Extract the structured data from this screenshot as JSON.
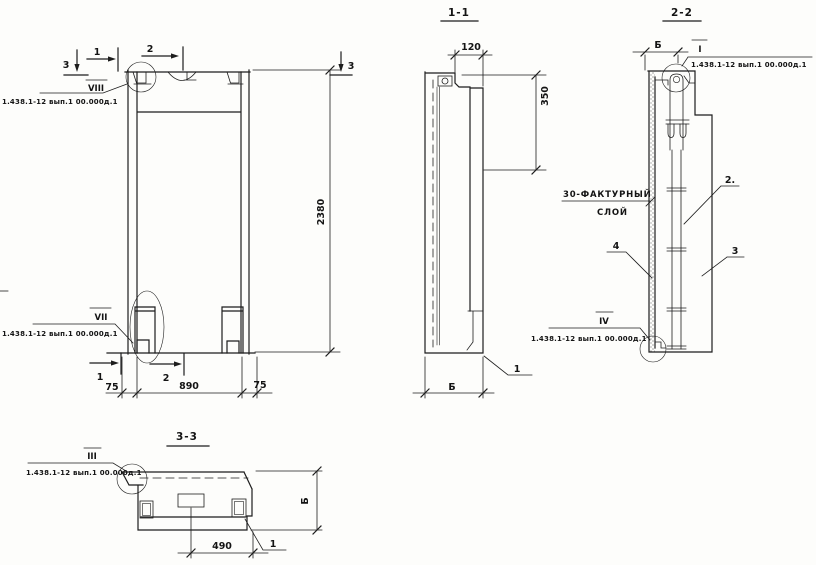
{
  "ref_note": "1.438.1-12 вып.1 00.000д.1",
  "front_view": {
    "detail_top": "VIII",
    "detail_bottom": "VII",
    "dim_height": "2380",
    "dim_left": "75",
    "dim_middle": "890",
    "dim_right": "75",
    "mark_1": "1",
    "mark_2": "2",
    "mark_3": "3"
  },
  "section_1_1": {
    "title": "1-1",
    "dim_top": "120",
    "dim_right": "350",
    "dim_bottom": "Б",
    "callout_1": "1"
  },
  "section_2_2": {
    "title": "2-2",
    "dim_top": "Б",
    "detail_top": "I",
    "detail_bottom": "IV",
    "note_line1": "30-ФАКТУРНЫЙ",
    "note_line2": "СЛОЙ",
    "callout_2": "2.",
    "callout_3": "3",
    "callout_4": "4"
  },
  "section_3_3": {
    "title": "3-3",
    "detail": "III",
    "dim_bottom": "490",
    "dim_right": "Б",
    "callout_1": "1"
  }
}
